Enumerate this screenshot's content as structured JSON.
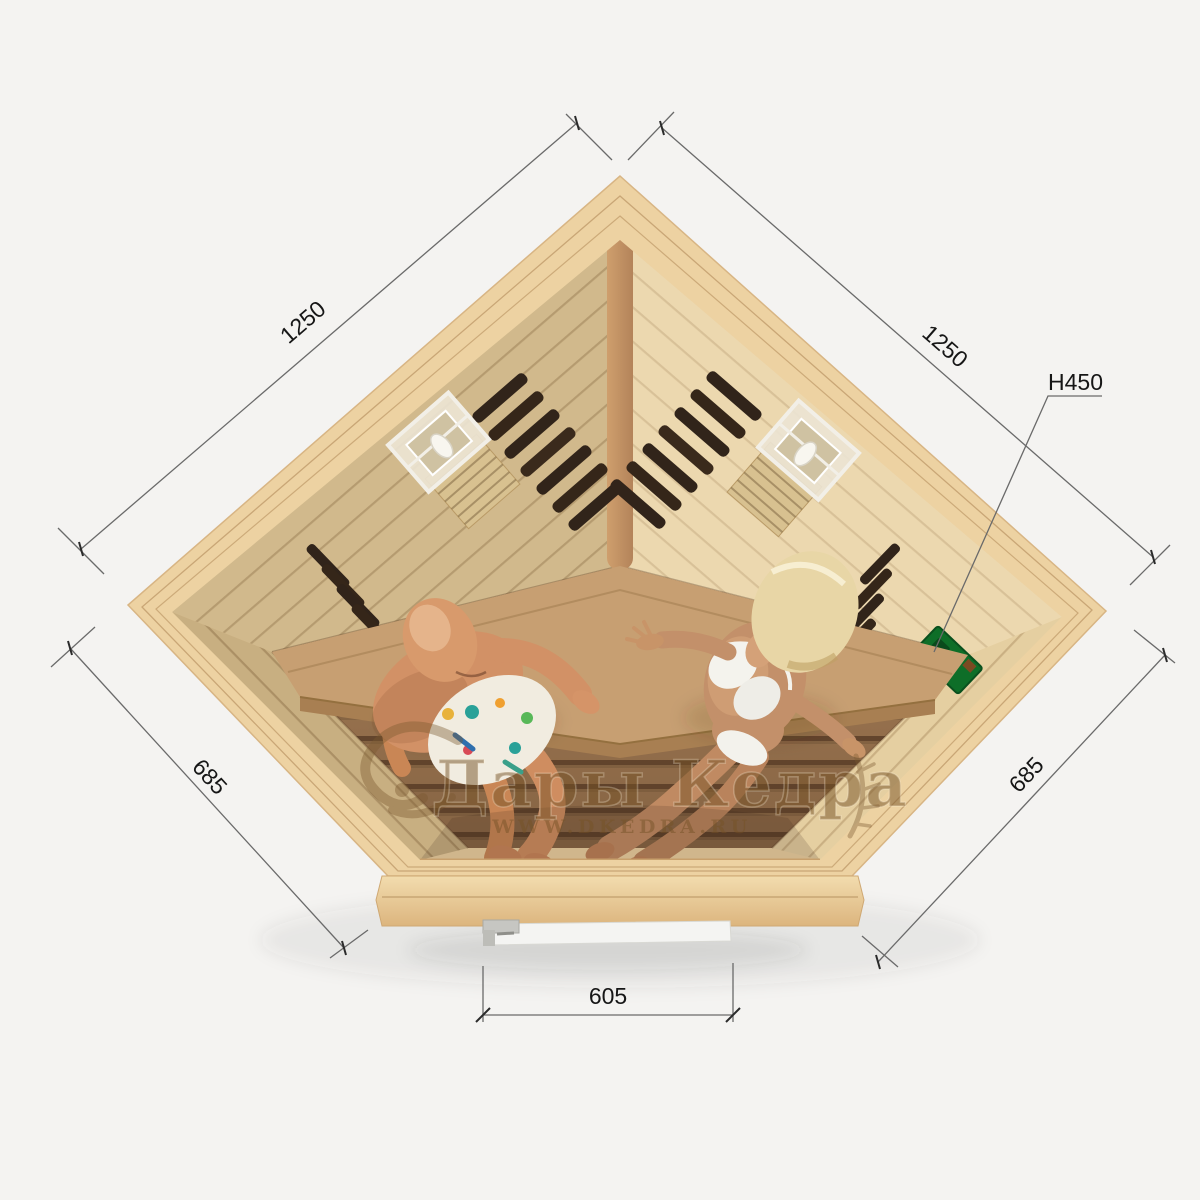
{
  "watermark": {
    "brand": "Дары Кедра",
    "website": "WWW.DKEDRA.RU"
  },
  "dimensions": {
    "back_left_wall": "1250",
    "back_right_wall": "1250",
    "side_left_wall": "685",
    "side_right_wall": "685",
    "front_door_width": "605",
    "height_label": "H450"
  },
  "colors": {
    "background": "#f4f3f1",
    "rim_wood": "#edd2a2",
    "wall_wood": "#e3cc9e",
    "floor_wood": "#a8825c",
    "bench_wood": "#c79f72",
    "heater_vent_dark": "#31241a",
    "control_panel_green": "#0e6e28",
    "door_white": "#f4f4f2",
    "dimension_line_gray": "#6a6a6a",
    "watermark_brown": "#76522a"
  },
  "scene_objects": [
    {
      "name": "corner-sauna-cabin"
    },
    {
      "name": "wall-lamp-left"
    },
    {
      "name": "wall-lamp-right"
    },
    {
      "name": "infrared-heater-back-left"
    },
    {
      "name": "infrared-heater-back-right"
    },
    {
      "name": "infrared-heater-side-left"
    },
    {
      "name": "infrared-heater-side-right"
    },
    {
      "name": "control-panel"
    },
    {
      "name": "corner-bench"
    },
    {
      "name": "man-sitting"
    },
    {
      "name": "woman-sitting"
    },
    {
      "name": "glass-front-door"
    },
    {
      "name": "door-handle"
    }
  ]
}
